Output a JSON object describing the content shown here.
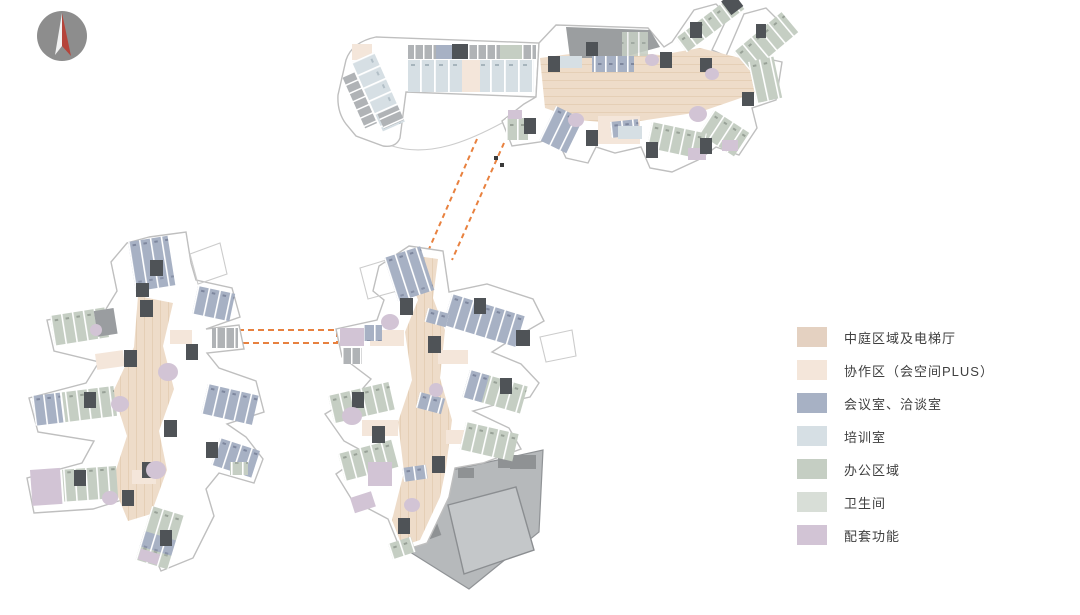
{
  "page": {
    "background": "#ffffff"
  },
  "colors": {
    "atrium": "#eedcc9",
    "collab": "#f4e6da",
    "meeting": "#a7b1c4",
    "training": "#d6dfe4",
    "office": "#c5cec3",
    "restroom": "#d8ded7",
    "amenity": "#d2c4d5",
    "core": "#4f5357",
    "service": "#9a9da0",
    "roof": "#9b9ea0",
    "podium": "#b6b9bb",
    "hall": "#c4c7c9",
    "outline": "#bfbfbf",
    "bridge": "#e8813f",
    "compass_body": "#8d8d8d",
    "compass_red": "#b5443a",
    "compass_white": "#f2f2f2",
    "text": "#3f3f3f"
  },
  "legend": {
    "items": [
      {
        "label": "中庭区域及电梯厅",
        "color": "#e4d1c1"
      },
      {
        "label": "协作区（会空间PLUS）",
        "color": "#f4e6da"
      },
      {
        "label": "会议室、洽谈室",
        "color": "#a7b1c4"
      },
      {
        "label": "培训室",
        "color": "#d6dfe4"
      },
      {
        "label": "办公区域",
        "color": "#c5cec3"
      },
      {
        "label": "卫生间",
        "color": "#d8ded7"
      },
      {
        "label": "配套功能",
        "color": "#d2c4d5"
      }
    ]
  }
}
